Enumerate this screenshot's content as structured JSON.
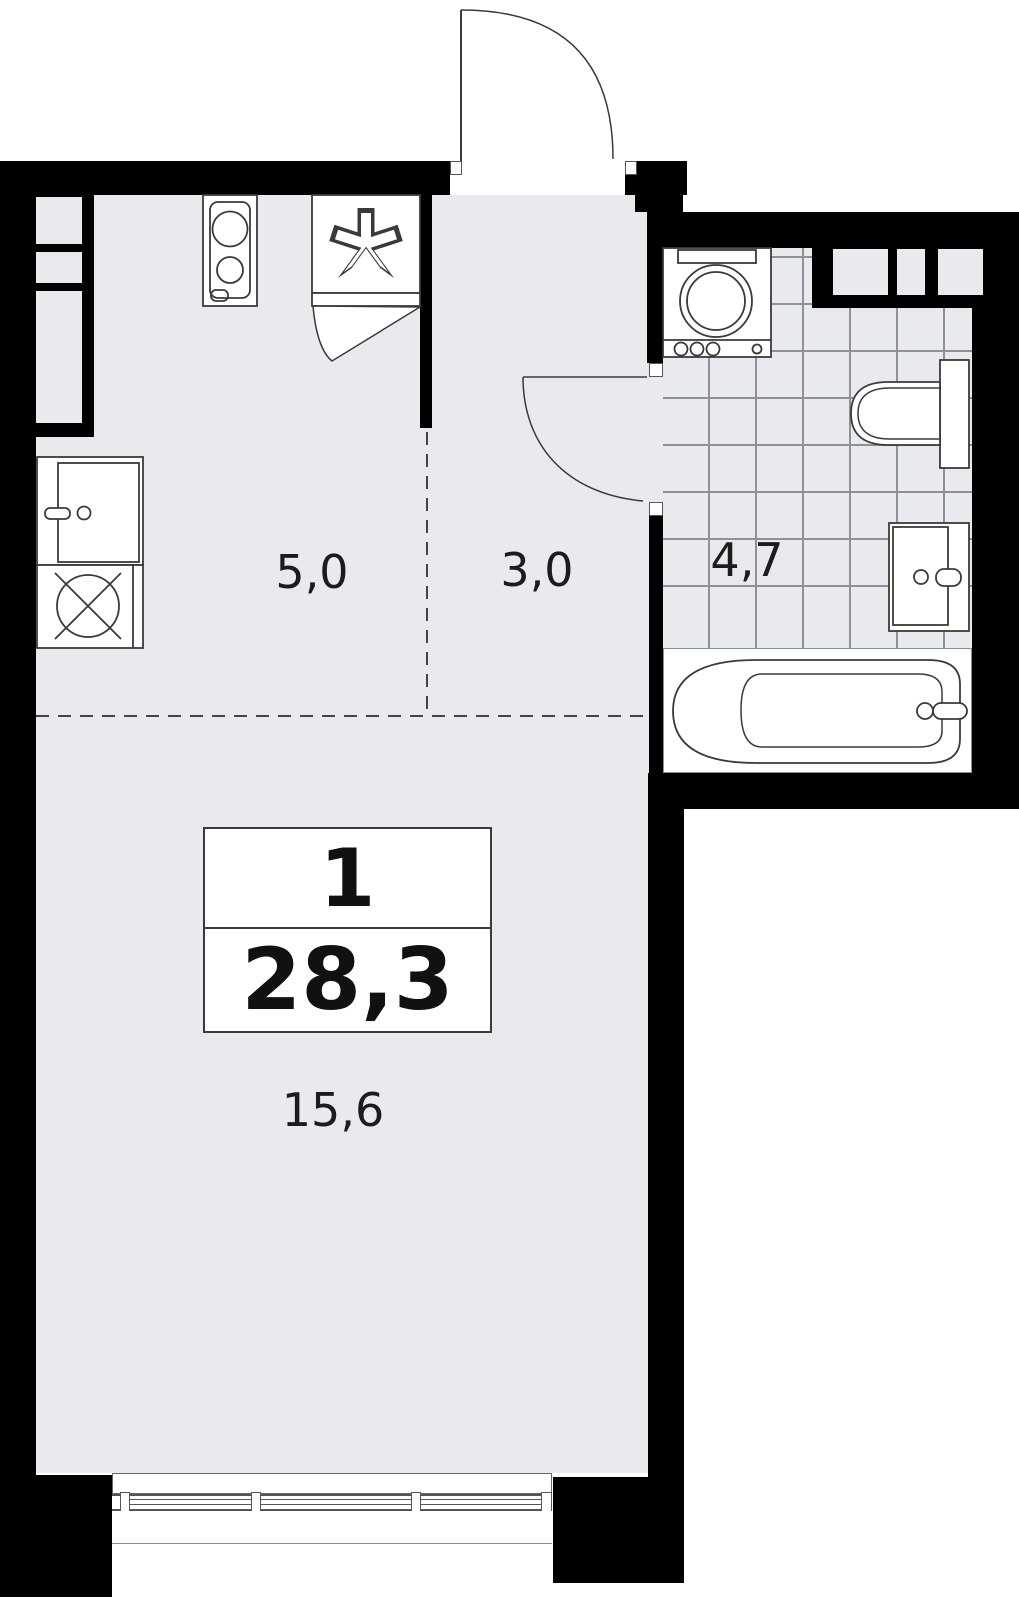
{
  "plan": {
    "unit_card": {
      "rooms_count": "1",
      "total_area_m2": "28,3"
    },
    "rooms": {
      "kitchen": {
        "area": "5,0"
      },
      "hallway": {
        "area": "3,0"
      },
      "bathroom": {
        "area": "4,7"
      },
      "living_room": {
        "area": "15,6"
      }
    },
    "fixtures": [
      "stove",
      "refrigerator",
      "kitchen-sink",
      "kitchen-unit",
      "washing-machine",
      "toilet",
      "bathroom-sink",
      "bathtub",
      "entry-door",
      "bathroom-door",
      "window"
    ],
    "colors": {
      "wall": "#000000",
      "floor": "#e8eaed",
      "tile_line": "#8d9299",
      "fixture_stroke": "#3a3a3a",
      "background": "#ffffff"
    }
  }
}
